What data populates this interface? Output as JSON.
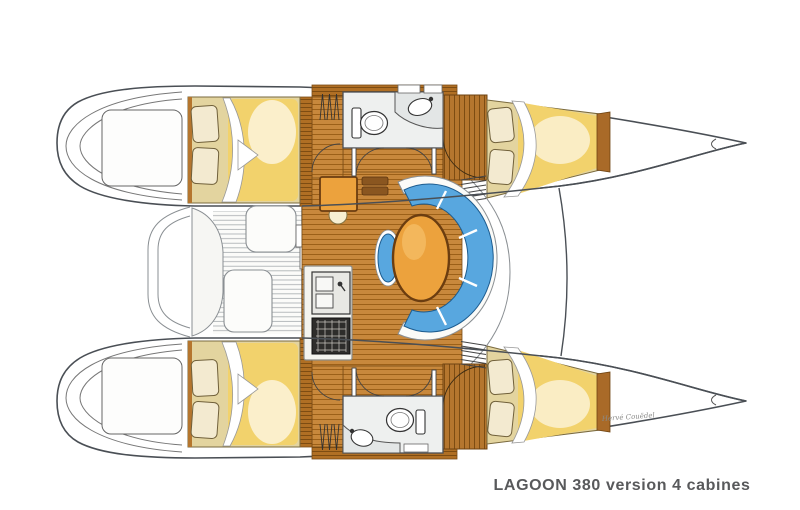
{
  "caption": "LAGOON 380 version 4 cabines",
  "signature": "Hervé Couëdel",
  "colors": {
    "outline": "#4a4f55",
    "wood": "#c8883c",
    "wood_dark": "#b06f24",
    "table_orange": "#eca23d",
    "sofa_blue": "#58a7df",
    "duvet_yellow": "#f2d26c",
    "bed_base": "#e3d49f",
    "caption_gray": "#58595b"
  }
}
